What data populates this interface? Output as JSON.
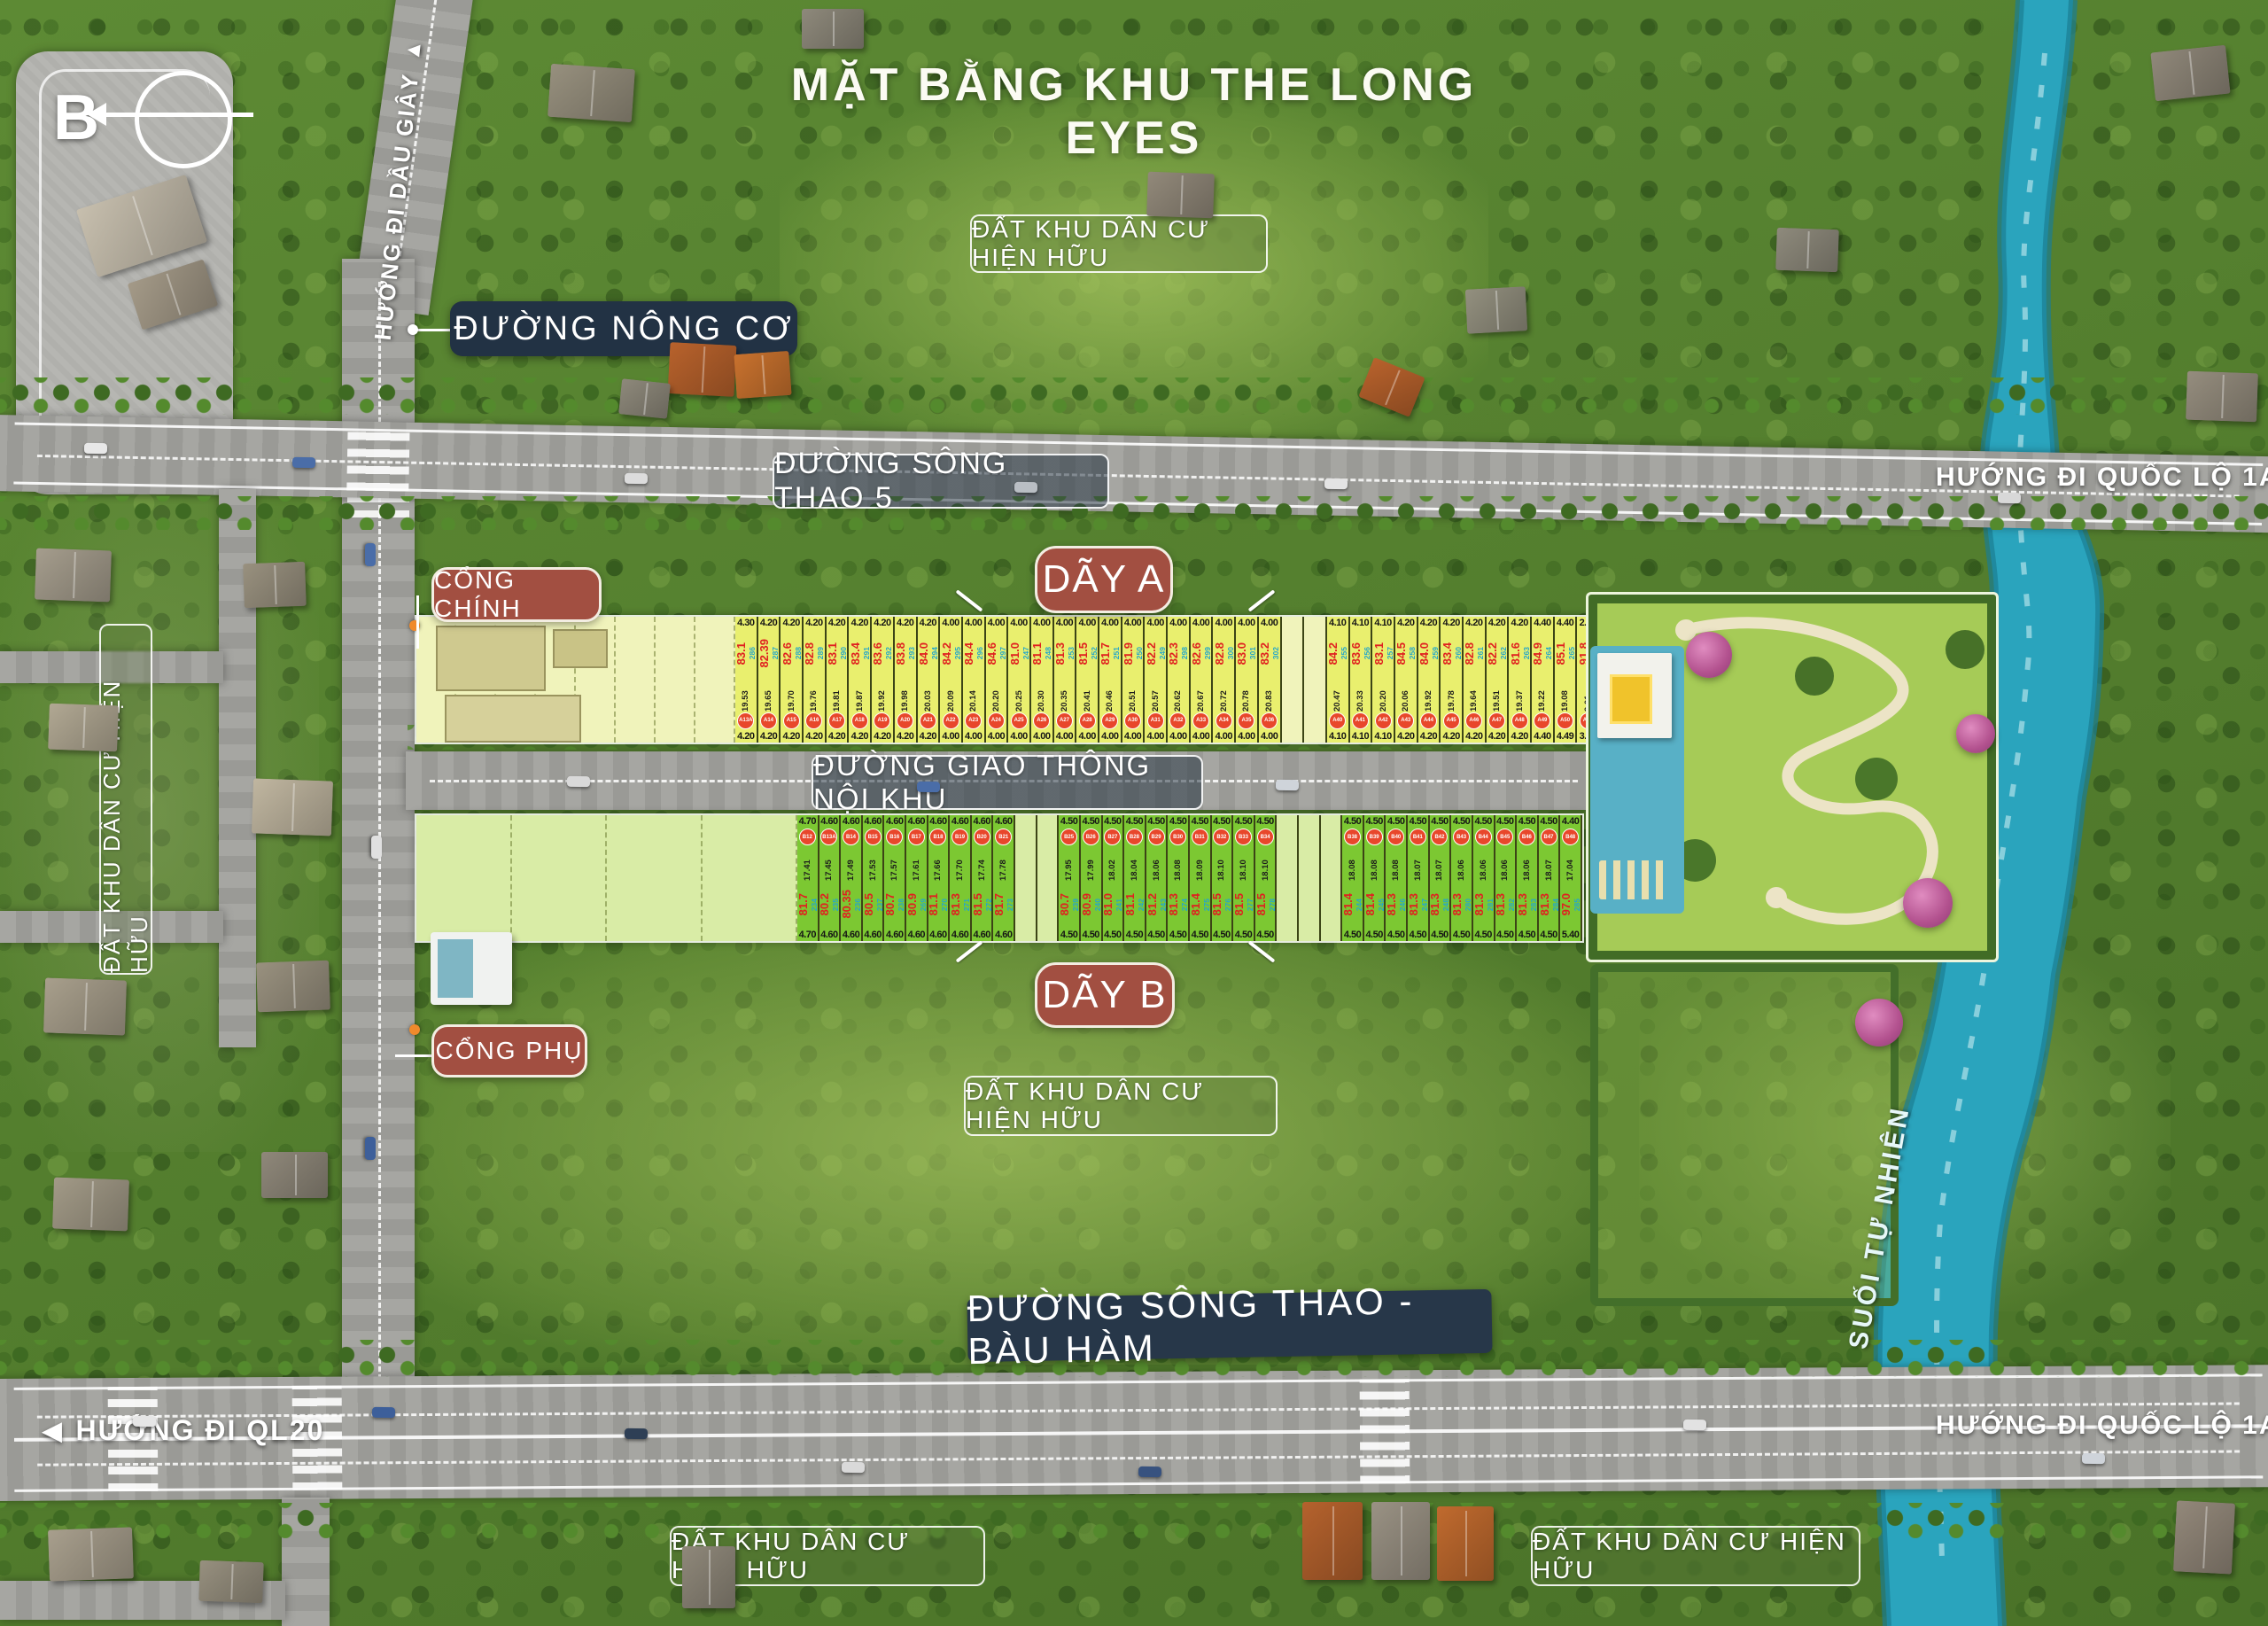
{
  "title": "MẶT BẰNG KHU THE LONG EYES",
  "compass": {
    "letter": "B"
  },
  "icons": {
    "arrow_up": "▲",
    "arrow_right": "▶",
    "arrow_left": "◀"
  },
  "labels": {
    "direction_dau_giay": "HƯỚNG ĐI DẦU GIÂY",
    "road_nong_co": "ĐƯỜNG NÔNG CƠ",
    "existing_residential": "ĐẤT KHU DÂN CƯ HIỆN HỮU",
    "road_song_thao_5": "ĐƯỜNG SÔNG THAO 5",
    "direction_quoc_lo_1a": "HƯỚNG ĐI QUỐC LỘ 1A",
    "main_gate": "CỔNG CHÍNH",
    "row_a": "DÃY A",
    "internal_road": "ĐƯỜNG GIAO THÔNG NỘI KHU",
    "row_b": "DÃY B",
    "secondary_gate": "CỔNG PHỤ",
    "road_song_thao_bau_ham": "ĐƯỜNG SÔNG THAO - BÀU HÀM",
    "direction_ql20": "HƯỚNG ĐI QL20",
    "natural_stream": "SUỐI TỰ NHIÊN"
  },
  "colors": {
    "navy_box": "#223244",
    "maroon_box": "#a24f41",
    "lot_yellow": "#e9ef6e",
    "lot_green": "#7cc832",
    "pale_yellow": "#f0f3bb",
    "pale_green": "#d9eca6",
    "area_red": "#e02020",
    "plot_teal": "#26a7c9",
    "circle_red": "#e8472b",
    "stream_teal": "#2aa4bd"
  },
  "row_a_lots": [
    {
      "id": "A13A",
      "area": "83.1",
      "plot": "286",
      "front": "4.30",
      "depth": "19.53",
      "rear": "4.20"
    },
    {
      "id": "A14",
      "area": "82.39",
      "plot": "287",
      "front": "4.20",
      "depth": "19.65",
      "rear": "4.20"
    },
    {
      "id": "A15",
      "area": "82.6",
      "plot": "288",
      "front": "4.20",
      "depth": "19.70",
      "rear": "4.20"
    },
    {
      "id": "A16",
      "area": "82.8",
      "plot": "289",
      "front": "4.20",
      "depth": "19.76",
      "rear": "4.20"
    },
    {
      "id": "A17",
      "area": "83.1",
      "plot": "290",
      "front": "4.20",
      "depth": "19.81",
      "rear": "4.20"
    },
    {
      "id": "A18",
      "area": "83.4",
      "plot": "291",
      "front": "4.20",
      "depth": "19.87",
      "rear": "4.20"
    },
    {
      "id": "A19",
      "area": "83.6",
      "plot": "292",
      "front": "4.20",
      "depth": "19.92",
      "rear": "4.20"
    },
    {
      "id": "A20",
      "area": "83.8",
      "plot": "293",
      "front": "4.20",
      "depth": "19.98",
      "rear": "4.20"
    },
    {
      "id": "A21",
      "area": "84.0",
      "plot": "294",
      "front": "4.20",
      "depth": "20.03",
      "rear": "4.20"
    },
    {
      "id": "A22",
      "area": "84.2",
      "plot": "295",
      "front": "4.00",
      "depth": "20.09",
      "rear": "4.00"
    },
    {
      "id": "A23",
      "area": "84.4",
      "plot": "296",
      "front": "4.00",
      "depth": "20.14",
      "rear": "4.00"
    },
    {
      "id": "A24",
      "area": "84.6",
      "plot": "297",
      "front": "4.00",
      "depth": "20.20",
      "rear": "4.00"
    },
    {
      "id": "A25",
      "area": "81.0",
      "plot": "247",
      "front": "4.00",
      "depth": "20.25",
      "rear": "4.00"
    },
    {
      "id": "A26",
      "area": "81.1",
      "plot": "248",
      "front": "4.00",
      "depth": "20.30",
      "rear": "4.00"
    },
    {
      "id": "A27",
      "area": "81.3",
      "plot": "253",
      "front": "4.00",
      "depth": "20.35",
      "rear": "4.00"
    },
    {
      "id": "A28",
      "area": "81.5",
      "plot": "252",
      "front": "4.00",
      "depth": "20.41",
      "rear": "4.00"
    },
    {
      "id": "A29",
      "area": "81.7",
      "plot": "251",
      "front": "4.00",
      "depth": "20.46",
      "rear": "4.00"
    },
    {
      "id": "A30",
      "area": "81.9",
      "plot": "250",
      "front": "4.00",
      "depth": "20.51",
      "rear": "4.00"
    },
    {
      "id": "A31",
      "area": "82.2",
      "plot": "249",
      "front": "4.00",
      "depth": "20.57",
      "rear": "4.00"
    },
    {
      "id": "A32",
      "area": "82.3",
      "plot": "298",
      "front": "4.00",
      "depth": "20.62",
      "rear": "4.00"
    },
    {
      "id": "A33",
      "area": "82.6",
      "plot": "299",
      "front": "4.00",
      "depth": "20.67",
      "rear": "4.00"
    },
    {
      "id": "A34",
      "area": "82.8",
      "plot": "300",
      "front": "4.00",
      "depth": "20.72",
      "rear": "4.00"
    },
    {
      "id": "A35",
      "area": "83.0",
      "plot": "301",
      "front": "4.00",
      "depth": "20.78",
      "rear": "4.00"
    },
    {
      "id": "A36",
      "area": "83.2",
      "plot": "302",
      "front": "4.00",
      "depth": "20.83",
      "rear": "4.00"
    },
    {
      "gap": true
    },
    {
      "gap": true
    },
    {
      "id": "A40",
      "area": "84.2",
      "plot": "255",
      "front": "4.10",
      "depth": "20.47",
      "rear": "4.10"
    },
    {
      "id": "A41",
      "area": "83.6",
      "plot": "256",
      "front": "4.10",
      "depth": "20.33",
      "rear": "4.10"
    },
    {
      "id": "A42",
      "area": "83.1",
      "plot": "257",
      "front": "4.10",
      "depth": "20.20",
      "rear": "4.10"
    },
    {
      "id": "A43",
      "area": "84.5",
      "plot": "258",
      "front": "4.20",
      "depth": "20.06",
      "rear": "4.20"
    },
    {
      "id": "A44",
      "area": "84.0",
      "plot": "259",
      "front": "4.20",
      "depth": "19.92",
      "rear": "4.20"
    },
    {
      "id": "A45",
      "area": "83.4",
      "plot": "260",
      "front": "4.20",
      "depth": "19.78",
      "rear": "4.20"
    },
    {
      "id": "A46",
      "area": "82.8",
      "plot": "261",
      "front": "4.20",
      "depth": "19.64",
      "rear": "4.20"
    },
    {
      "id": "A47",
      "area": "82.2",
      "plot": "262",
      "front": "4.20",
      "depth": "19.51",
      "rear": "4.20"
    },
    {
      "id": "A48",
      "area": "81.6",
      "plot": "263",
      "front": "4.20",
      "depth": "19.37",
      "rear": "4.20"
    },
    {
      "id": "A49",
      "area": "84.9",
      "plot": "264",
      "front": "4.40",
      "depth": "19.22",
      "rear": "4.40"
    },
    {
      "id": "A50",
      "area": "85.1",
      "plot": "265",
      "front": "4.40",
      "depth": "19.08",
      "rear": "4.49"
    },
    {
      "id": "A51",
      "area": "91.8",
      "plot": "266",
      "front": "2.95",
      "depth": "9.01",
      "rear": "3.81"
    }
  ],
  "row_b_lots": [
    {
      "id": "B12",
      "area": "81.7",
      "plot": "234",
      "front": "4.70",
      "depth": "17.41",
      "rear": "4.70"
    },
    {
      "id": "B13A",
      "area": "80.2",
      "plot": "235",
      "front": "4.60",
      "depth": "17.45",
      "rear": "4.60"
    },
    {
      "id": "B14",
      "area": "80.35",
      "plot": "236",
      "front": "4.60",
      "depth": "17.49",
      "rear": "4.60"
    },
    {
      "id": "B15",
      "area": "80.5",
      "plot": "237",
      "front": "4.60",
      "depth": "17.53",
      "rear": "4.60"
    },
    {
      "id": "B16",
      "area": "80.7",
      "plot": "238",
      "front": "4.60",
      "depth": "17.57",
      "rear": "4.60"
    },
    {
      "id": "B17",
      "area": "80.9",
      "plot": "269",
      "front": "4.60",
      "depth": "17.61",
      "rear": "4.60"
    },
    {
      "id": "B18",
      "area": "81.1",
      "plot": "270",
      "front": "4.60",
      "depth": "17.66",
      "rear": "4.60"
    },
    {
      "id": "B19",
      "area": "81.3",
      "plot": "271",
      "front": "4.60",
      "depth": "17.70",
      "rear": "4.60"
    },
    {
      "id": "B20",
      "area": "81.5",
      "plot": "272",
      "front": "4.60",
      "depth": "17.74",
      "rear": "4.60"
    },
    {
      "id": "B21",
      "area": "81.7",
      "plot": "273",
      "front": "4.60",
      "depth": "17.78",
      "rear": "4.60"
    },
    {
      "gap": true
    },
    {
      "gap": true
    },
    {
      "id": "B25",
      "area": "80.7",
      "plot": "239",
      "front": "4.50",
      "depth": "17.95",
      "rear": "4.50"
    },
    {
      "id": "B26",
      "area": "80.9",
      "plot": "240",
      "front": "4.50",
      "depth": "17.99",
      "rear": "4.50"
    },
    {
      "id": "B27",
      "area": "81.0",
      "plot": "241",
      "front": "4.50",
      "depth": "18.02",
      "rear": "4.50"
    },
    {
      "id": "B28",
      "area": "81.1",
      "plot": "242",
      "front": "4.50",
      "depth": "18.04",
      "rear": "4.50"
    },
    {
      "id": "B29",
      "area": "81.2",
      "plot": "243",
      "front": "4.50",
      "depth": "18.06",
      "rear": "4.50"
    },
    {
      "id": "B30",
      "area": "81.3",
      "plot": "274",
      "front": "4.50",
      "depth": "18.08",
      "rear": "4.50"
    },
    {
      "id": "B31",
      "area": "81.4",
      "plot": "275",
      "front": "4.50",
      "depth": "18.09",
      "rear": "4.50"
    },
    {
      "id": "B32",
      "area": "81.5",
      "plot": "276",
      "front": "4.50",
      "depth": "18.10",
      "rear": "4.50"
    },
    {
      "id": "B33",
      "area": "81.5",
      "plot": "277",
      "front": "4.50",
      "depth": "18.10",
      "rear": "4.50"
    },
    {
      "id": "B34",
      "area": "81.5",
      "plot": "278",
      "front": "4.50",
      "depth": "18.10",
      "rear": "4.50"
    },
    {
      "gap": true
    },
    {
      "gap": true
    },
    {
      "gap": true
    },
    {
      "id": "B38",
      "area": "81.4",
      "plot": "244",
      "front": "4.50",
      "depth": "18.08",
      "rear": "4.50"
    },
    {
      "id": "B39",
      "area": "81.4",
      "plot": "245",
      "front": "4.50",
      "depth": "18.08",
      "rear": "4.50"
    },
    {
      "id": "B40",
      "area": "81.3",
      "plot": "246",
      "front": "4.50",
      "depth": "18.08",
      "rear": "4.50"
    },
    {
      "id": "B41",
      "area": "81.3",
      "plot": "247",
      "front": "4.50",
      "depth": "18.07",
      "rear": "4.50"
    },
    {
      "id": "B42",
      "area": "81.3",
      "plot": "248",
      "front": "4.50",
      "depth": "18.07",
      "rear": "4.50"
    },
    {
      "id": "B43",
      "area": "81.3",
      "plot": "280",
      "front": "4.50",
      "depth": "18.06",
      "rear": "4.50"
    },
    {
      "id": "B44",
      "area": "81.3",
      "plot": "281",
      "front": "4.50",
      "depth": "18.06",
      "rear": "4.50"
    },
    {
      "id": "B45",
      "area": "81.3",
      "plot": "282",
      "front": "4.50",
      "depth": "18.06",
      "rear": "4.50"
    },
    {
      "id": "B46",
      "area": "81.3",
      "plot": "283",
      "front": "4.50",
      "depth": "18.06",
      "rear": "4.50"
    },
    {
      "id": "B47",
      "area": "81.3",
      "plot": "284",
      "front": "4.50",
      "depth": "18.07",
      "rear": "4.50"
    },
    {
      "id": "B48",
      "area": "97.0",
      "plot": "285",
      "front": "4.40",
      "depth": "17.04",
      "rear": "5.40"
    }
  ]
}
